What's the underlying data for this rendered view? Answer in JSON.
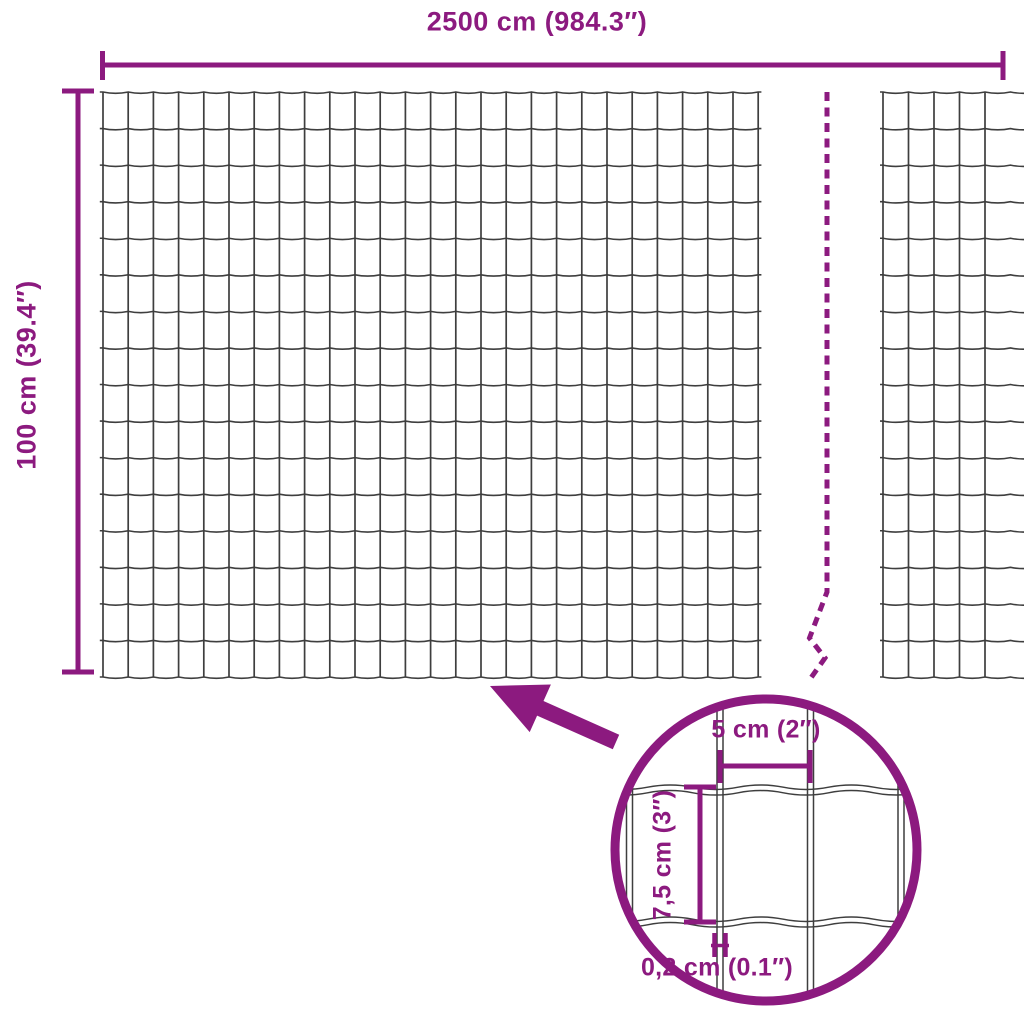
{
  "title": "Wire mesh fence dimension diagram",
  "colors": {
    "accent": "#8C1A7F",
    "wire": "#3E3E3E",
    "background": "#FFFFFF"
  },
  "overall_dimensions": {
    "width_label": "2500 cm (984.3″)",
    "height_label": "100 cm (39.4″)"
  },
  "detail_dimensions": {
    "mesh_cell_width_label": "5 cm (2″)",
    "mesh_cell_height_label": "7,5 cm (3″)",
    "wire_thickness_label": "0,2 cm (0.1″)"
  }
}
